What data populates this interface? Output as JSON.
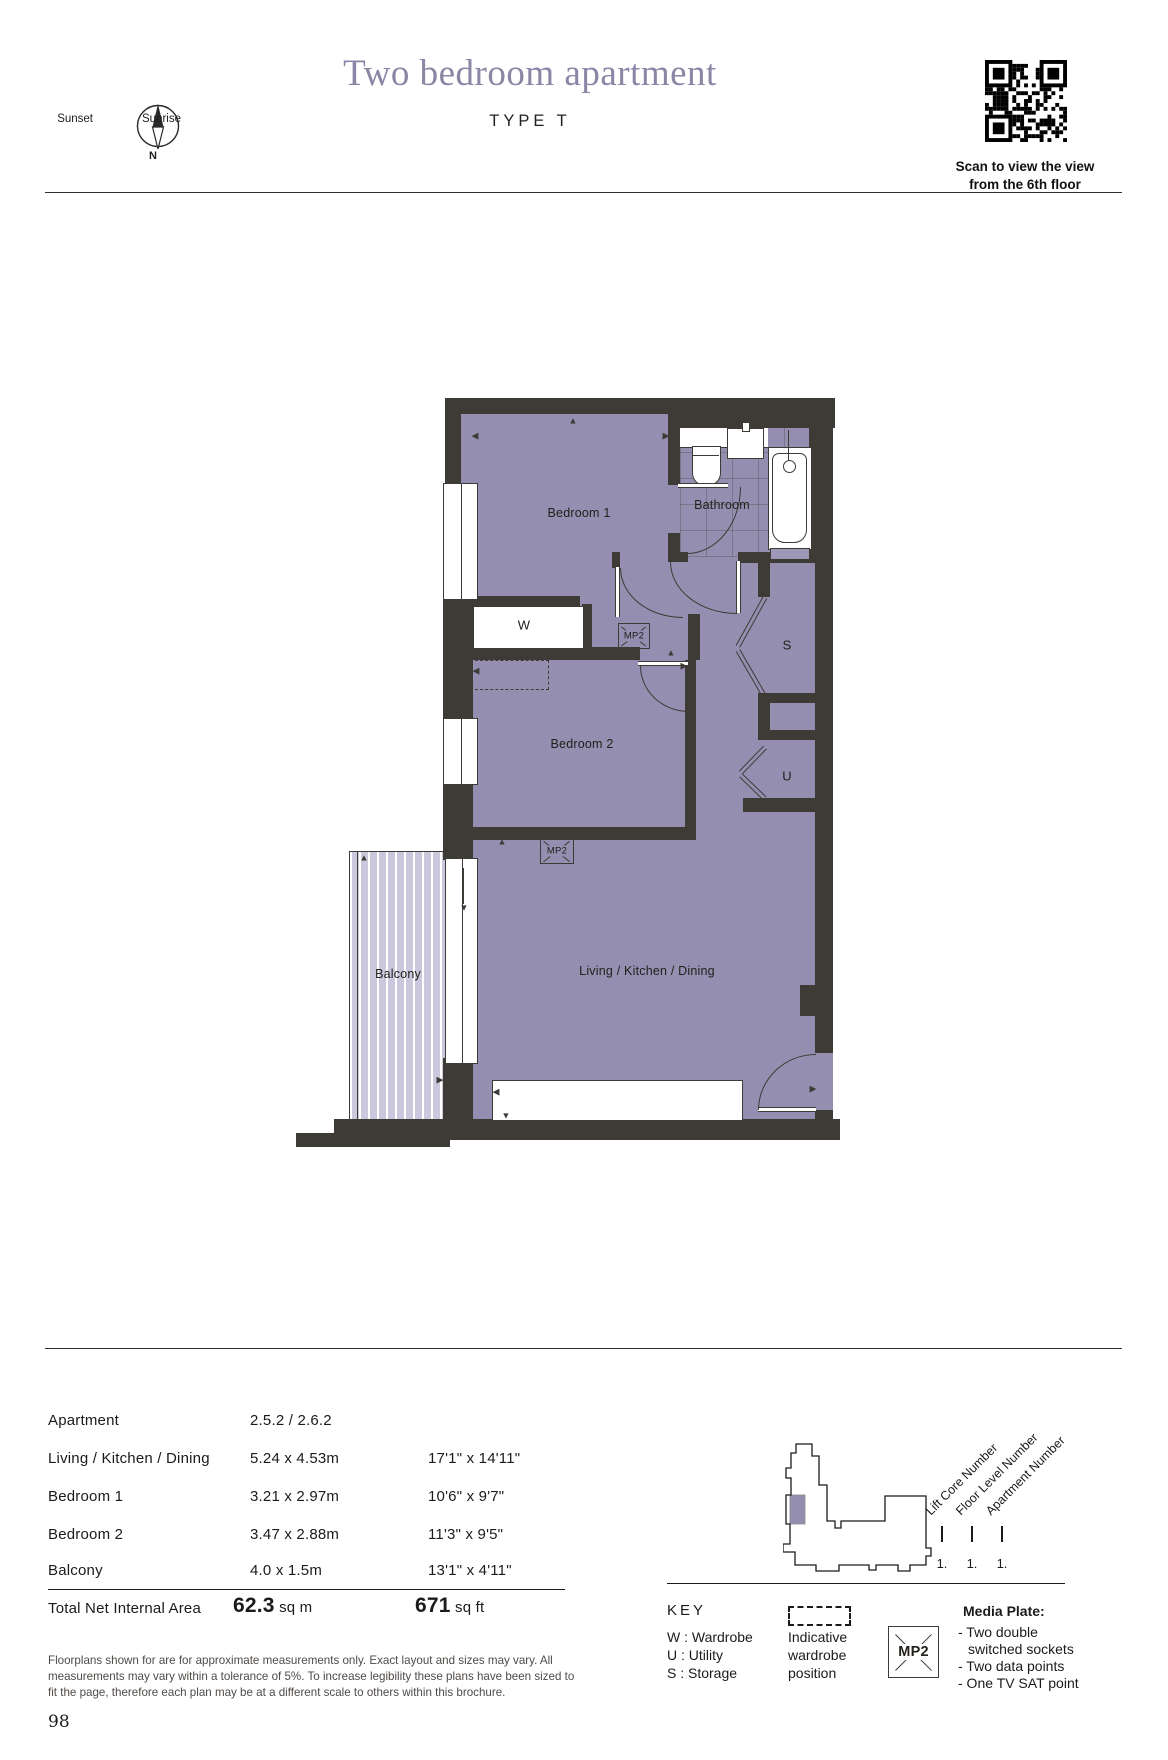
{
  "header": {
    "title": "Two bedroom apartment",
    "subtitle": "TYPE T",
    "compass": {
      "north": "N",
      "left": "Sunset",
      "right": "Sunrise"
    },
    "qr": {
      "caption_line1": "Scan to view the view",
      "caption_line2": "from the 6th floor"
    }
  },
  "plan": {
    "rooms": {
      "bedroom1": "Bedroom 1",
      "bathroom": "Bathroom",
      "bedroom2": "Bedroom 2",
      "balcony": "Balcony",
      "living": "Living / Kitchen / Dining",
      "wardrobe": "W",
      "storage": "S",
      "utility": "U",
      "mp2": "MP2"
    }
  },
  "table": {
    "rows": [
      {
        "label": "Apartment",
        "metric": "2.5.2 / 2.6.2",
        "imperial": ""
      },
      {
        "label": "Living / Kitchen / Dining",
        "metric": "5.24 x 4.53m",
        "imperial": "17'1\" x 14'11\""
      },
      {
        "label": "Bedroom 1",
        "metric": "3.21 x 2.97m",
        "imperial": "10'6\" x 9'7\""
      },
      {
        "label": "Bedroom 2",
        "metric": "3.47 x  2.88m",
        "imperial": "11'3\" x 9'5\""
      },
      {
        "label": "Balcony",
        "metric": "4.0 x 1.5m",
        "imperial": "13'1\" x 4'11\""
      }
    ],
    "total": {
      "label": "Total Net Internal Area",
      "metric_value": "62.3",
      "metric_unit": "sq m",
      "imperial_value": "671",
      "imperial_unit": "sq ft"
    }
  },
  "locator": {
    "labels": [
      "Lift Core Number",
      "Floor Level Number",
      "Apartment Number"
    ],
    "values": [
      "1.",
      "1.",
      "1."
    ]
  },
  "key": {
    "heading": "KEY",
    "items": [
      "W : Wardrobe",
      "U : Utility",
      "S : Storage"
    ],
    "wardrobe_note": [
      "Indicative",
      "wardrobe",
      "position"
    ],
    "mp2_label": "MP2",
    "media_plate_title": "Media Plate:",
    "media_plate_lines": [
      "- Two double",
      "switched sockets",
      "- Two data points",
      "- One TV SAT point"
    ]
  },
  "disclaimer": {
    "lines": [
      "Floorplans shown for are for approximate measurements only. Exact layout and sizes may vary. All",
      "measurements may vary within a tolerance of 5%. To increase legibility these plans have been sized to",
      "fit the page, therefore each plan may be at a different scale to others within this brochure."
    ]
  },
  "meta": {
    "page_number": "98"
  },
  "colors": {
    "accent": "#8A86A5",
    "room_fill": "#948EB0",
    "balcony_fill": "#CBC7DC",
    "wall": "#3E3A35"
  }
}
